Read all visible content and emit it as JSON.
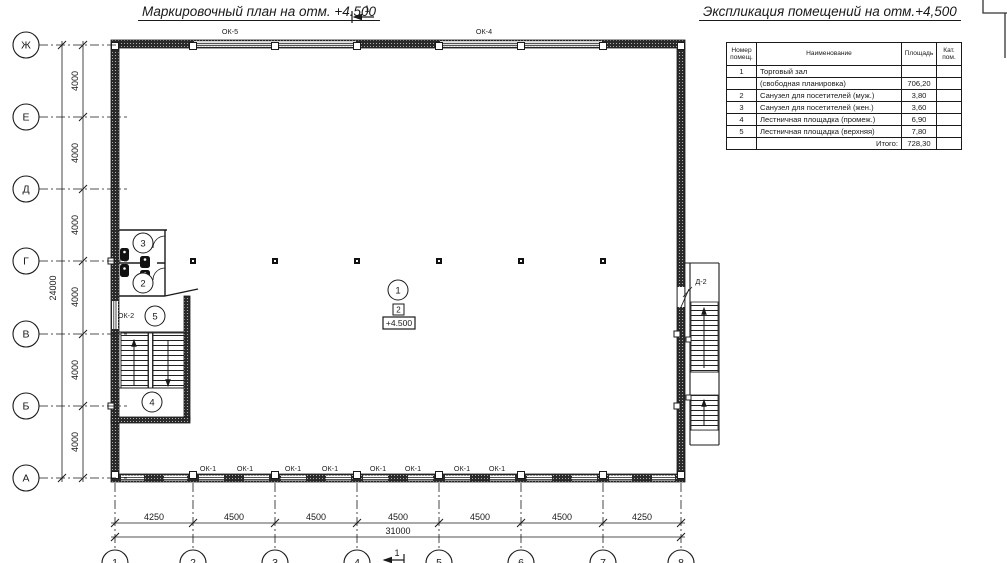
{
  "colors": {
    "ink": "#1a1a1a",
    "paper": "#ffffff"
  },
  "plan_title": "Маркировочный план на отм. +4.500",
  "explication_title": "Экспликация помещений на отм.+4,500",
  "section_marks": {
    "top": "1",
    "bottom": "1"
  },
  "table": {
    "headers": [
      "Номер помещ.",
      "Наименование",
      "Площадь",
      "Кат. пом."
    ],
    "rows": [
      [
        "1",
        "Торговый зал",
        "",
        ""
      ],
      [
        "",
        "(свободная планировка)",
        "706,20",
        ""
      ],
      [
        "2",
        "Санузел для посетителей (муж.)",
        "3,80",
        ""
      ],
      [
        "3",
        "Санузел для посетителей (жен.)",
        "3,60",
        ""
      ],
      [
        "4",
        "Лестничная площадка (промеж.)",
        "6,90",
        ""
      ],
      [
        "5",
        "Лестничная площадка (верхняя)",
        "7,80",
        ""
      ],
      [
        "",
        "Итого:",
        "728,30",
        ""
      ]
    ]
  },
  "axes_rows": [
    "Ж",
    "Е",
    "Д",
    "Г",
    "В",
    "Б",
    "А"
  ],
  "axes_cols": [
    "1",
    "2",
    "3",
    "4",
    "5",
    "6",
    "7",
    "8"
  ],
  "dims": {
    "left": [
      "4000",
      "4000",
      "4000",
      "4000",
      "4000",
      "4000"
    ],
    "left_total": "24000",
    "bottom": [
      "4250",
      "4500",
      "4500",
      "4500",
      "4500",
      "4500",
      "4250"
    ],
    "bottom_total": "31000"
  },
  "room_markers": {
    "r1": "1",
    "r2": "2",
    "r3": "3",
    "r4": "4",
    "r5": "5"
  },
  "marks": {
    "ok5": "ОК-5",
    "ok4": "ОК-4",
    "ok2": "ОК-2",
    "d2": "Д-2",
    "ok1_labels": [
      "ОК-1",
      "ОК-1",
      "ОК-1",
      "ОК-1",
      "ОК-1",
      "ОК-1",
      "ОК-1",
      "ОК-1"
    ],
    "level_box": "+4.500",
    "floor_marker": "2"
  }
}
